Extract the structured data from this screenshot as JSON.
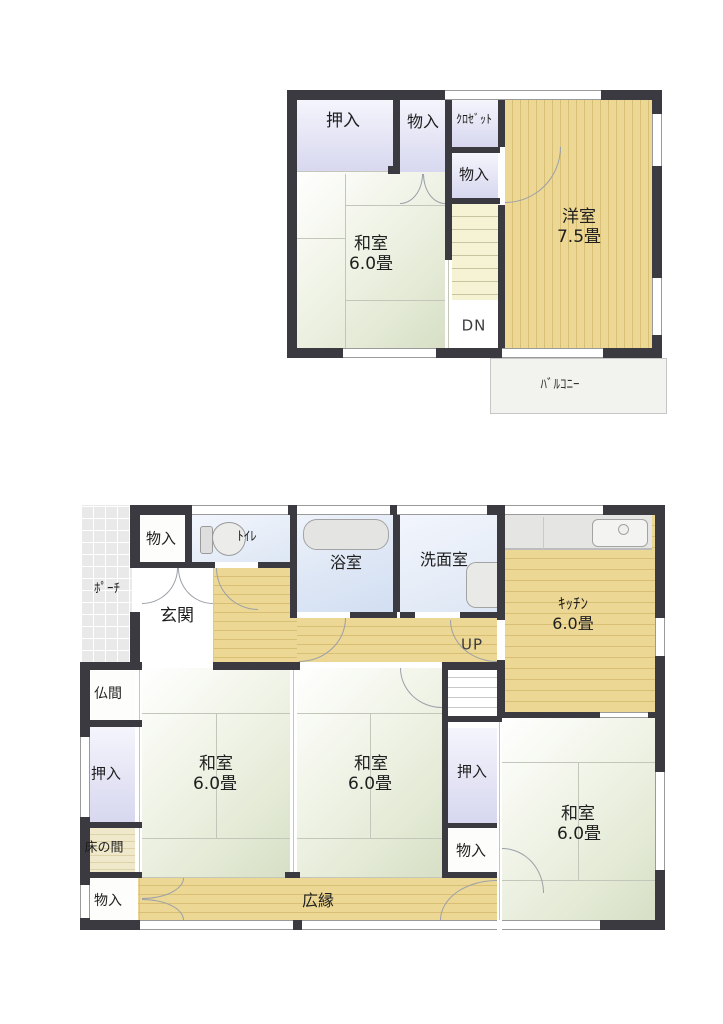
{
  "title": "二階建て住宅 間取り図",
  "colors": {
    "wall": "#3a3a40",
    "tatami": "#e5ebd7",
    "wood_floor": "#ecd795",
    "closet": "#e4e4f5",
    "water_room": "#dde6f5",
    "tokonoma": "#efe8ca",
    "balcony": "#f2f2ee",
    "porch_tile": "#e9e9e9"
  },
  "floor2": {
    "oshiire": "押入",
    "monoire_a": "物入",
    "closet": "ｸﾛｾﾞｯﾄ",
    "monoire_b": "物入",
    "washitsu": {
      "label": "和室",
      "size": "6.0畳"
    },
    "yoshitsu": {
      "label": "洋室",
      "size": "7.5畳"
    },
    "stairs_down": "DN",
    "balcony": "ﾊﾞﾙｺﾆｰ"
  },
  "floor1": {
    "porch": "ﾎﾟｰﾁ",
    "monoire_entry": "物入",
    "toilet": "ﾄｲﾚ",
    "bath": "浴室",
    "washroom": "洗面室",
    "kitchen": {
      "label": "ｷｯﾁﾝ",
      "size": "6.0畳"
    },
    "genkan": "玄関",
    "stairs_up": "UP",
    "butsuma": "仏間",
    "oshiire_left": "押入",
    "tokonoma": "床の間",
    "monoire_bottom_left": "物入",
    "washitsu_a": {
      "label": "和室",
      "size": "6.0畳"
    },
    "washitsu_b": {
      "label": "和室",
      "size": "6.0畳"
    },
    "oshiire_mid": "押入",
    "monoire_mid": "物入",
    "washitsu_c": {
      "label": "和室",
      "size": "6.0畳"
    },
    "hiroen": "広縁"
  }
}
